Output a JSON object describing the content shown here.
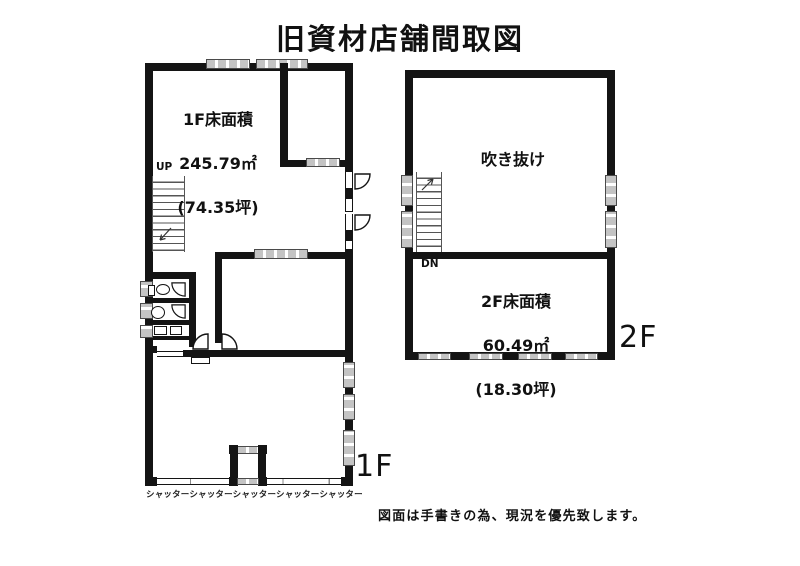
{
  "title": "旧資材店舗間取図",
  "floor1": {
    "area_label": "1F床面積",
    "area_sqm": "245.79㎡",
    "area_tsubo": "(74.35坪)",
    "up_label": "UP",
    "shutter_label": "シャッターシャッターシャッターシャッターシャッター",
    "floor_tag": "1F"
  },
  "floor2": {
    "void_label": "吹き抜け",
    "dn_label": "DN",
    "area_label": "2F床面積",
    "area_sqm": "60.49㎡",
    "area_tsubo": "(18.30坪)",
    "floor_tag": "2F"
  },
  "footer_note": "図面は手書きの為、現況を優先致します。",
  "colors": {
    "wall": "#141414",
    "window": "#c4c4c4"
  }
}
